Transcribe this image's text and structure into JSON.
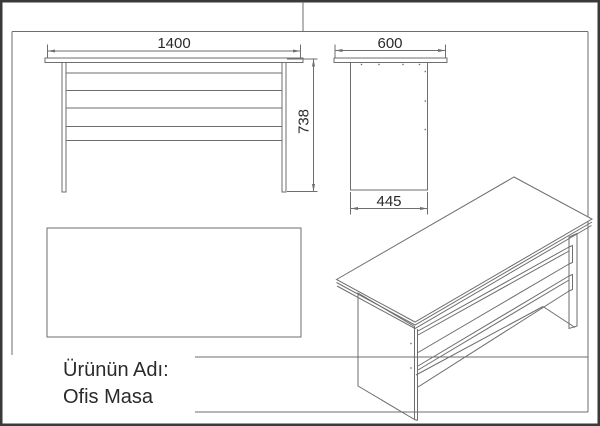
{
  "title_block": {
    "product_label": "Ürünün Adı:",
    "product_name": "Ofis Masa"
  },
  "dimensions": {
    "front_width_mm": "1400",
    "overall_height_mm": "738",
    "top_depth_mm": "600",
    "panel_depth_mm": "445"
  },
  "colors": {
    "line": "#6e6e6e",
    "border": "#3a3a3a",
    "text": "#2a2a2a"
  }
}
